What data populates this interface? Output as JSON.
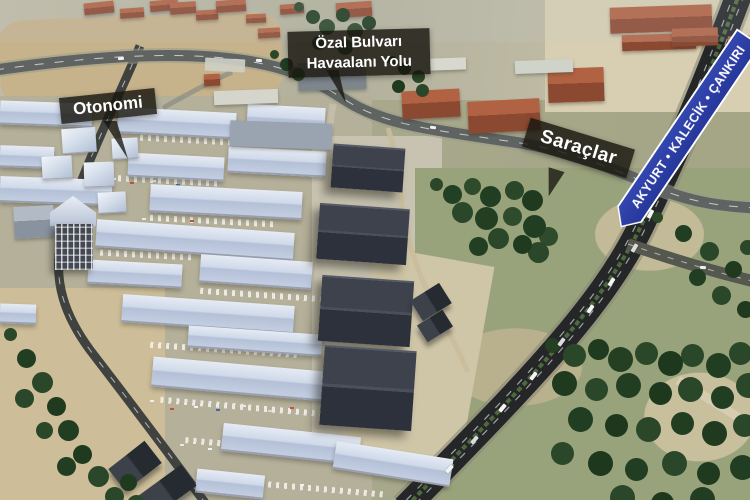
{
  "scene": {
    "title": "Aerial 3D map view",
    "area": "Otonomi industrial district and highway interchange"
  },
  "labels": {
    "boulevard": {
      "line1": "Özal Bulvarı",
      "line2": "Havaalanı Yolu"
    },
    "complex": {
      "text": "Otonomi"
    },
    "district": {
      "text": "Saraçlar"
    }
  },
  "road_sign": {
    "text": "AKYURT • KALECİK • ÇANKIRI",
    "destinations": [
      "AKYURT",
      "KALECİK",
      "ÇANKIRI"
    ],
    "bg_color": "#2b3f9e",
    "border_color": "#ffffff",
    "text_color": "#ffffff"
  },
  "palette": {
    "label_bg": "rgba(24,22,15,0.82)",
    "label_text": "#ffffff",
    "warehouse_roof": "#ccd7e8",
    "hangar_roof": "#3a3f49",
    "red_roof": "#a4543a",
    "highway_asphalt": "#242628",
    "median_green": "#52683c",
    "tree_green": "#2b4527",
    "ground_tan": "#b9ae90",
    "grass_green": "#98a179"
  }
}
